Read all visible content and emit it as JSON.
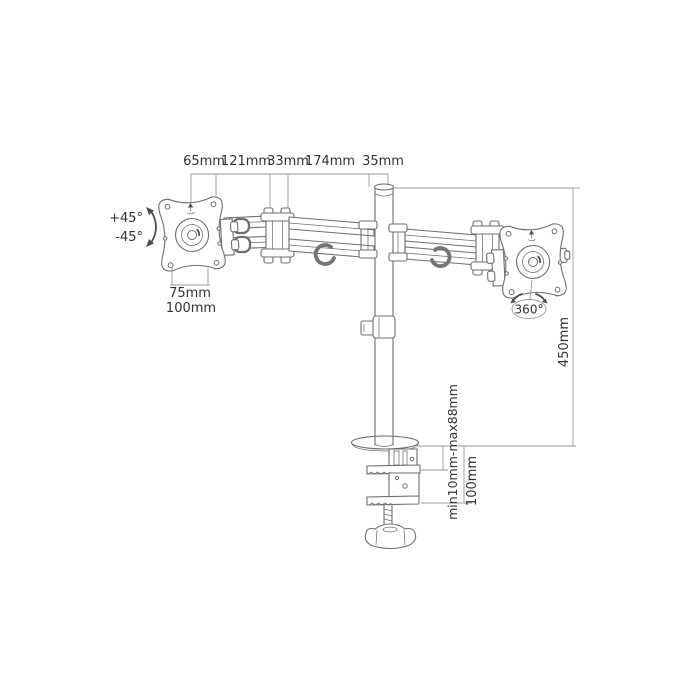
{
  "diagram": {
    "description": "dual monitor desk mount arm dimension drawing",
    "top_dimensions": {
      "d1": "65mm",
      "d2": "121mm",
      "d3": "33mm",
      "d4": "174mm",
      "d5": "35mm"
    },
    "left_plate": {
      "tilt_up": "+45°",
      "tilt_down": "-45°",
      "vesa_inner": "75mm",
      "vesa_outer": "100mm"
    },
    "right_plate": {
      "rotation": "360°"
    },
    "pole": {
      "height": "450mm"
    },
    "clamp": {
      "thickness_range": "min10mm-max88mm",
      "depth": "100mm"
    },
    "colors": {
      "background": "#ffffff",
      "line": "#6f6f6f",
      "dim_line": "#9a9a9a",
      "text": "#333333"
    }
  }
}
